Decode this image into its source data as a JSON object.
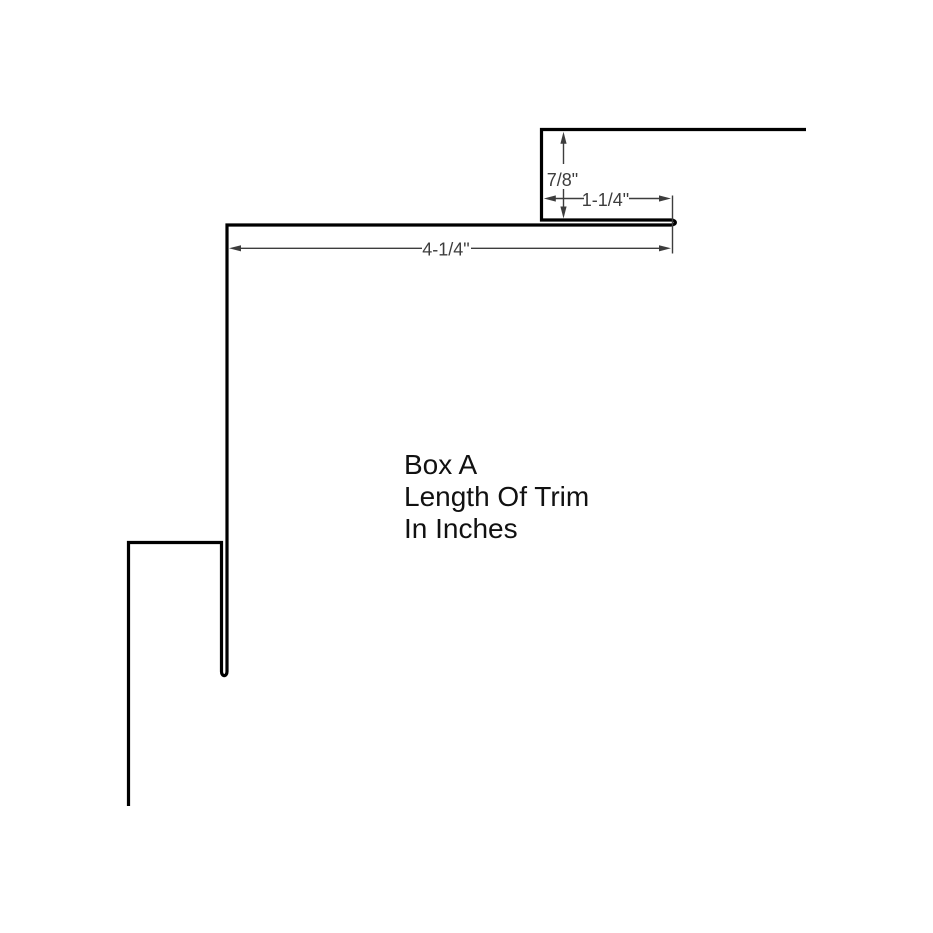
{
  "labels": {
    "title_lines": [
      "Box A",
      "Length Of Trim",
      "In Inches"
    ]
  },
  "dimensions": {
    "top_flange_height": "7/8\"",
    "top_flange_width": "1-1/4\"",
    "face_width": "4-1/4\""
  },
  "colors": {
    "background": "#ffffff",
    "profile_line": "#000000",
    "dimension": "#3d3d3d",
    "label_text": "#111111"
  }
}
